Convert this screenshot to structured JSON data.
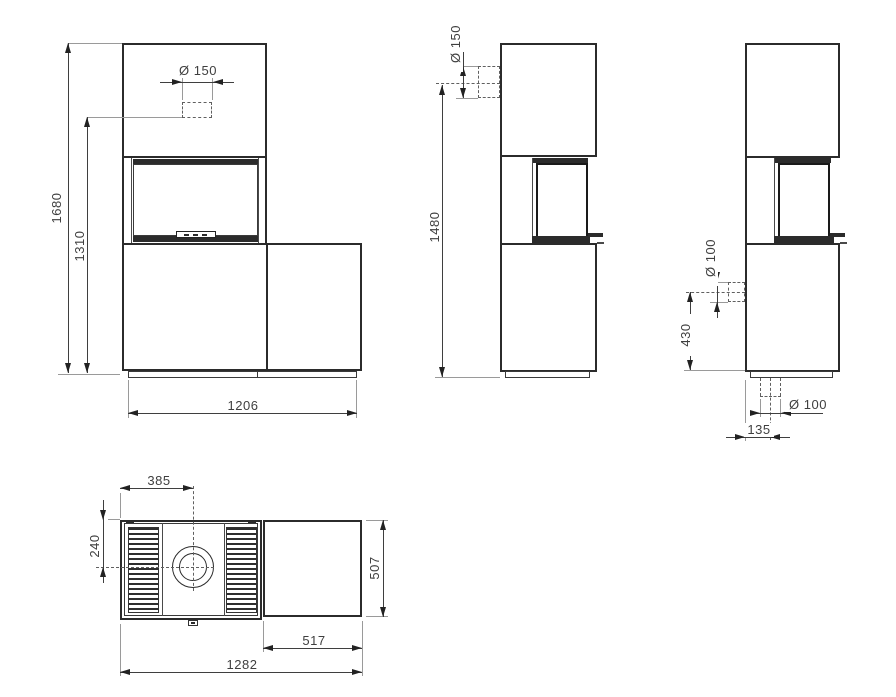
{
  "drawing": {
    "colors": {
      "line": "#2b2b2b",
      "dim_line": "#3f3f3f",
      "extension_line": "#9a9a9a",
      "text": "#3f3f3f",
      "background": "#ffffff"
    },
    "views": {
      "front": {
        "dims": {
          "total_height": "1680",
          "flue_height": "1310",
          "flue_diameter": "Ø 150",
          "width": "1206"
        }
      },
      "side": {
        "dims": {
          "flue_diameter": "Ø 150",
          "rear_flue_height": "1480"
        }
      },
      "rear": {
        "dims": {
          "air_inlet_diameter": "Ø 100",
          "air_inlet_height": "430",
          "floor_inlet_diameter": "Ø 100",
          "floor_inlet_offset": "135"
        }
      },
      "top": {
        "dims": {
          "flue_from_left": "385",
          "flue_from_back": "240",
          "depth": "507",
          "bench_width": "517",
          "total_width": "1282"
        }
      }
    }
  }
}
